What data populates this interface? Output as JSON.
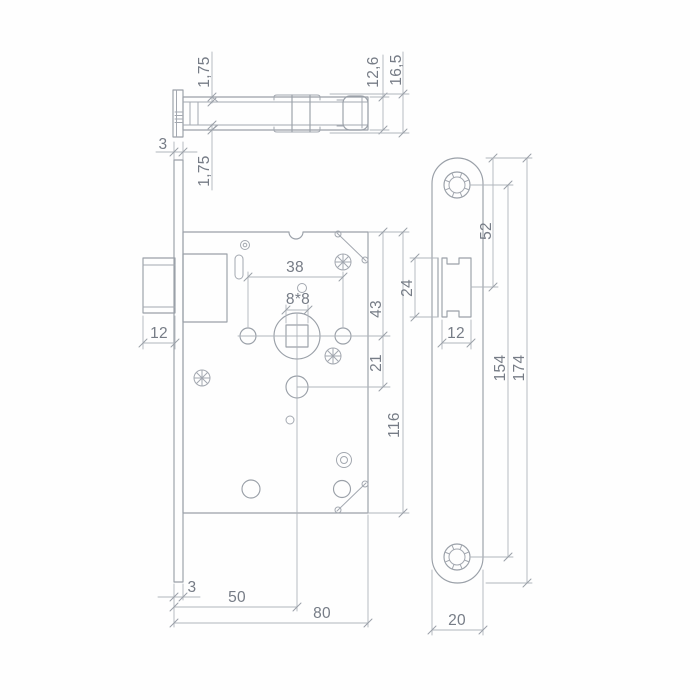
{
  "drawing": {
    "subject": "mortise-door-lock-dimensional-drawing",
    "units": "mm",
    "line_color": "#9aa0a8",
    "text_color": "#767c86",
    "top_view": {
      "dims": {
        "lip_front": "1,75",
        "case_thickness": "12,6",
        "hub_height": "16,5",
        "faceplate_thickness": "3",
        "lip_back": "1,75"
      }
    },
    "front_view": {
      "dims": {
        "latch_throw": "12",
        "hole_spacing": "38",
        "spindle_square": "8*8",
        "top_edge_to_spindle": "43",
        "spindle_to_cylinder": "21",
        "case_height": "116",
        "faceplate_thickness": "3",
        "backset": "50",
        "case_depth": "80"
      }
    },
    "faceplate_view": {
      "dims": {
        "latch_height": "24",
        "latch_width": "12",
        "top_to_latch_center": "52",
        "screw_spacing": "154",
        "plate_length": "174",
        "plate_width": "20"
      }
    }
  }
}
